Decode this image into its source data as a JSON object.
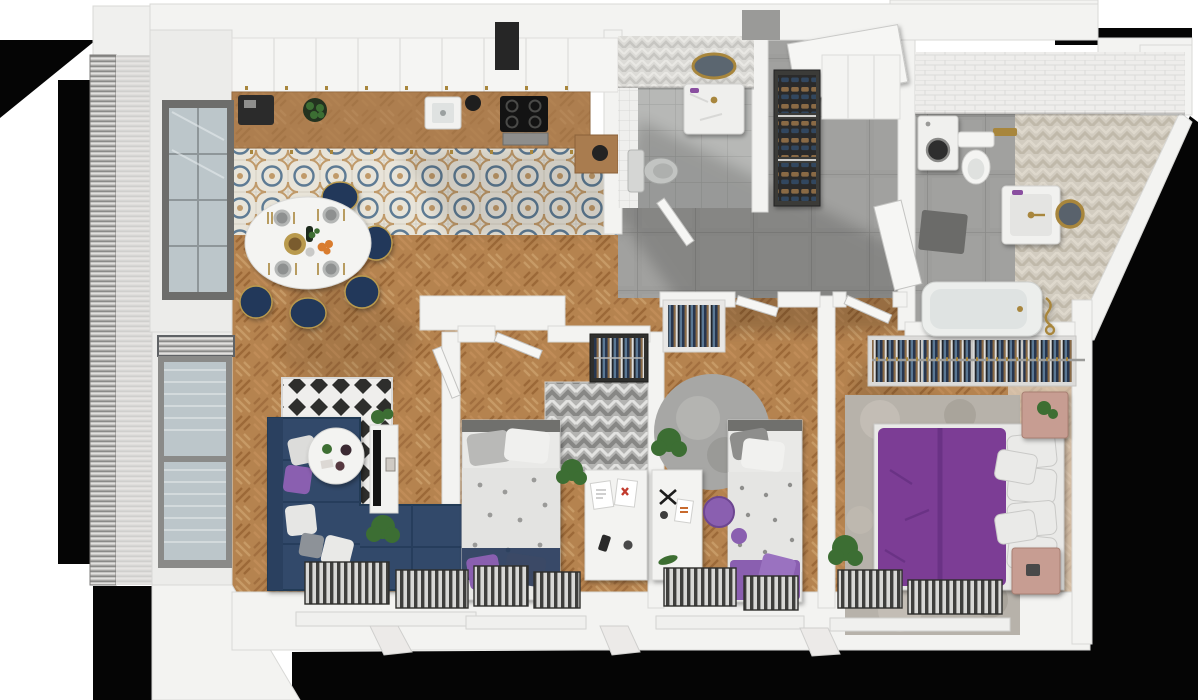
{
  "scene": {
    "type": "3d-floor-plan-render",
    "description": "Top-down axonometric render of a 3-bedroom apartment with balcony, open kitchen-living area, hallway, WC and bathroom",
    "background": "#ffffff"
  },
  "palette": {
    "wall": "#f3f3f1",
    "wall_edge": "#d8d8d6",
    "void_black": "#050505",
    "wood_base": "#b5834f",
    "wood_dark": "#a26f3f",
    "wood_light": "#c79a66",
    "tile_bg": "#e8e4d9",
    "tile_blue": "#5e7b94",
    "tile_tan": "#c09a6a",
    "concrete": "#9e9e9c",
    "bath_tile": "#b7b8b6",
    "chevron_floor": "#d2ccc0",
    "sofa_navy": "#31486a",
    "chair_navy": "#24395a",
    "bed_purple": "#7b3d95",
    "accent_purple": "#8a5fb0",
    "rug_dark": "#2e2e2c",
    "rug_gray": "#b3b3b1",
    "curtain": "#5f6265",
    "glass": "#bcc6ca",
    "gold": "#a8863c",
    "pink_wood": "#c79d92",
    "plant_green": "#3c6e33",
    "radiator": "#3f3f3d"
  },
  "counts": {
    "rooms": 9,
    "bedrooms": 3,
    "bathrooms": 2,
    "balconies": 1
  },
  "rooms": [
    {
      "name": "kitchen-dining",
      "floor": [
        "patterned-cement-tile",
        "herringbone-oak"
      ],
      "items": [
        "upper-cabinets-row",
        "tall-dark-cabinet",
        "wood-countertop",
        "coffee-machine",
        "fruit-bowl",
        "kitchen-sink",
        "induction-hob",
        "oven",
        "kettle-counter",
        "oval-dining-table",
        "navy-dining-chairs-x5",
        "table-place-settings",
        "window-to-balcony"
      ]
    },
    {
      "name": "living-room",
      "floor": [
        "herringbone-oak"
      ],
      "items": [
        "navy-corner-sofa",
        "cushions-x5",
        "bw-diamond-rug",
        "round-coffee-table",
        "tv-stand",
        "tv",
        "potted-plants-x2",
        "balcony-windows",
        "gray-curtains",
        "radiators-x2"
      ]
    },
    {
      "name": "bedroom-1",
      "floor": [
        "herringbone-oak"
      ],
      "items": [
        "single-bed-navy-white-bedding",
        "chevron-gray-rug",
        "white-desk",
        "wardrobe-with-clothes",
        "potted-plant",
        "radiators-x2",
        "door"
      ]
    },
    {
      "name": "bedroom-2",
      "floor": [
        "herringbone-oak"
      ],
      "items": [
        "single-bed-gray-pattern-bedding",
        "purple-throw",
        "round-gray-rug",
        "white-desk",
        "purple-chair",
        "open-wardrobe-with-clothes",
        "potted-plant",
        "radiators-x2",
        "door"
      ]
    },
    {
      "name": "master-bedroom",
      "floor": [
        "herringbone-oak"
      ],
      "items": [
        "double-bed-purple-duvet",
        "white-pillow-stack",
        "open-clothes-rail-4-sections",
        "textured-gray-rug",
        "pink-nightstands-x2",
        "potted-plant",
        "radiators-x2",
        "door"
      ]
    },
    {
      "name": "wc",
      "floor": [
        "gray-tile"
      ],
      "items": [
        "marble-vanity",
        "gold-oval-mirror",
        "gray-toilet",
        "chevron-tile-wall",
        "mosaic-wall-strip",
        "door"
      ]
    },
    {
      "name": "bathroom",
      "floor": [
        "gray-tile",
        "beige-chevron-tile"
      ],
      "items": [
        "washing-machine",
        "toilet",
        "marble-vanity",
        "gold-round-mirror",
        "bathtub-gold-fittings",
        "white-brick-wall",
        "wall-niche",
        "door"
      ]
    },
    {
      "name": "hallway",
      "floor": [
        "concrete-tile",
        "herringbone-oak-corridor"
      ],
      "items": [
        "entry-door",
        "shoe-rack-3-tiers",
        "white-entry-closet",
        "dark-doormat"
      ]
    },
    {
      "name": "balcony",
      "floor": [
        "metal-decking"
      ],
      "items": [
        "louvered-railing",
        "roof-band"
      ]
    }
  ]
}
